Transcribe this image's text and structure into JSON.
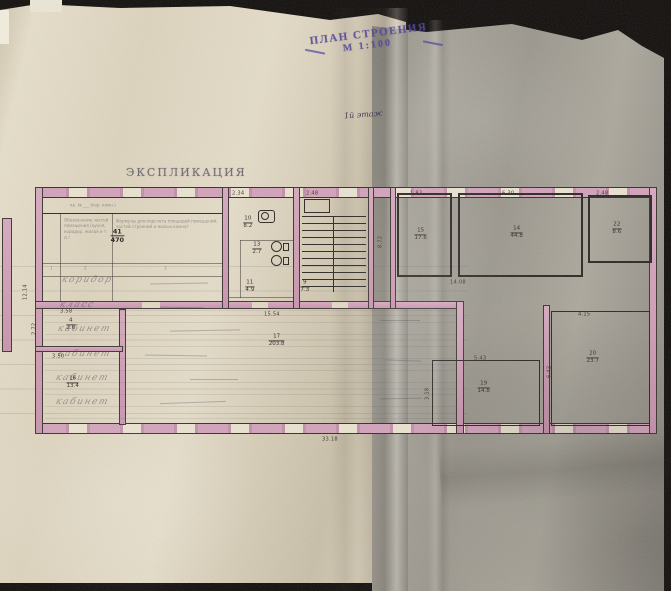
{
  "photo": {
    "paper_left_color": "#e0d7c1",
    "paper_right_color": "#a4a198",
    "wall_pink": "#d3a3ba",
    "ink": "#2e2824",
    "stamp_color": "#4a3e99"
  },
  "stamp": {
    "line1": "ПЛАН СТРОЕНИЯ",
    "line2": "М 1:100"
  },
  "floor_note": "1й этаж",
  "explication": {
    "title": "ЭКСПЛИКАЦИЯ",
    "header_note": "кв. № ___ (кор. комн.)",
    "col_parts": "Обозначение частей помещения (кухня, коридор, жилая и т. д.)",
    "col_formulas": "Формулы для подсчета площадей помещений, частей строений и жилых комнат",
    "col_numbers": [
      "1",
      "2",
      "3"
    ],
    "fraction": {
      "top": "41",
      "bottom": "470"
    }
  },
  "handwriting": {
    "rows": [
      "коридор",
      "класс",
      "кабинет",
      "кабинет",
      "кабинет",
      "кабинет"
    ]
  },
  "rooms": [
    {
      "n": "10",
      "a": "8.2"
    },
    {
      "n": "13",
      "a": "2.7"
    },
    {
      "n": "11",
      "a": "4.9"
    },
    {
      "n": "9",
      "a": "7.3"
    },
    {
      "n": "15",
      "a": "17.6"
    },
    {
      "n": "14",
      "a": "44.8"
    },
    {
      "n": "22",
      "a": "8.6"
    },
    {
      "n": "4",
      "a": "2.6"
    },
    {
      "n": "16",
      "a": "13.4"
    },
    {
      "n": "17",
      "a": "203.8"
    },
    {
      "n": "19",
      "a": "14.8"
    },
    {
      "n": "20",
      "a": "23.7"
    }
  ],
  "dims": [
    "2.34",
    "2.48",
    "1.82",
    "6.30",
    "2.48",
    "14.08",
    "15.54",
    "5.43",
    "4.15",
    "33.18",
    "12.14",
    "3.50",
    "3.58",
    "3.18",
    "2.72",
    "6.42",
    "8.72"
  ]
}
